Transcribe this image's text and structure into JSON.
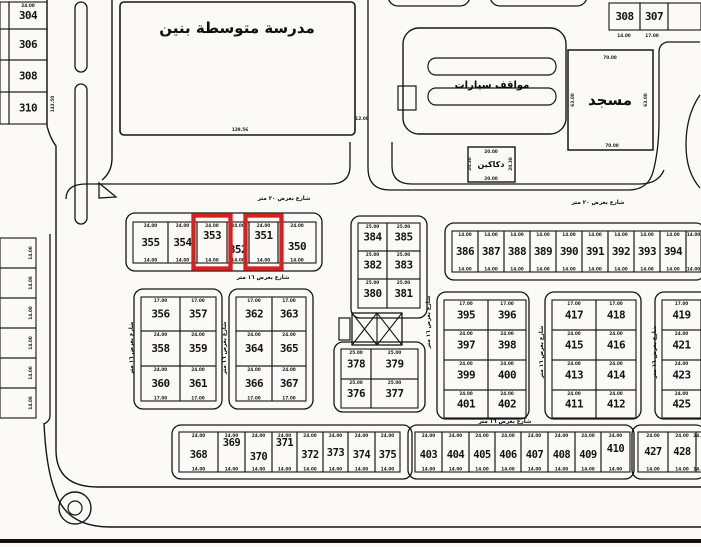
{
  "map": {
    "facilities": {
      "school": "مدرسة متوسطة بنين",
      "parking": "مواقف سيارات",
      "mosque": "مسجد",
      "shops": "دكاكين"
    },
    "streets": {
      "street_20m": "شارع بعرض ٢٠ متر",
      "street_16m": "شارع بعرض ١٦ متر"
    },
    "highlights": {
      "plots": [
        "353",
        "351"
      ],
      "color": "#d92020"
    },
    "dims": {
      "d14": "14.00",
      "d17": "17.00",
      "d24": "24.00",
      "d25": "25.00",
      "d20": "20.00",
      "d2030": "20.30",
      "d70": "70.00",
      "d63": "63.00",
      "d12956": "129.56",
      "d1200": "12.00",
      "d14350": "143.50"
    },
    "blocks": {
      "left_col": [
        [
          "304"
        ],
        [
          "306"
        ],
        [
          "308"
        ],
        [
          "310"
        ]
      ],
      "left_sliver": [
        [
          ""
        ],
        [
          ""
        ],
        [
          ""
        ],
        [
          ""
        ]
      ],
      "top_right": [
        [
          "308",
          "307",
          ""
        ]
      ],
      "row_350": [
        [
          "355",
          "354",
          "353",
          "352",
          "351",
          "350"
        ]
      ],
      "mid_col": [
        [
          "384",
          "385"
        ],
        [
          "382",
          "383"
        ],
        [
          "380",
          "381"
        ]
      ],
      "row_386": [
        [
          "386",
          "387",
          "388",
          "389",
          "390",
          "391",
          "392",
          "393",
          "394",
          ""
        ]
      ],
      "block_356": [
        [
          "356",
          "357"
        ],
        [
          "358",
          "359"
        ],
        [
          "360",
          "361"
        ]
      ],
      "block_362": [
        [
          "362",
          "363"
        ],
        [
          "364",
          "365"
        ],
        [
          "366",
          "367"
        ]
      ],
      "block_378": [
        [
          "378",
          "379"
        ],
        [
          "376",
          "377"
        ]
      ],
      "block_395": [
        [
          "395",
          "396"
        ],
        [
          "397",
          "398"
        ],
        [
          "399",
          "400"
        ],
        [
          "401",
          "402"
        ]
      ],
      "block_417": [
        [
          "417",
          "418"
        ],
        [
          "415",
          "416"
        ],
        [
          "413",
          "414"
        ],
        [
          "411",
          "412"
        ]
      ],
      "block_419": [
        [
          "419",
          ""
        ],
        [
          "421",
          ""
        ],
        [
          "423",
          ""
        ],
        [
          "425",
          ""
        ]
      ],
      "row_368": [
        [
          "368",
          "369",
          "370",
          "371",
          "372",
          "373",
          "374",
          "375"
        ]
      ],
      "row_403": [
        [
          "403",
          "404",
          "405",
          "406",
          "407",
          "408",
          "409",
          "410"
        ]
      ],
      "block_427": [
        [
          "427",
          "428",
          ""
        ]
      ],
      "left_strip": [
        [
          ""
        ],
        [
          ""
        ],
        [
          ""
        ],
        [
          ""
        ],
        [
          ""
        ],
        [
          ""
        ]
      ]
    }
  }
}
